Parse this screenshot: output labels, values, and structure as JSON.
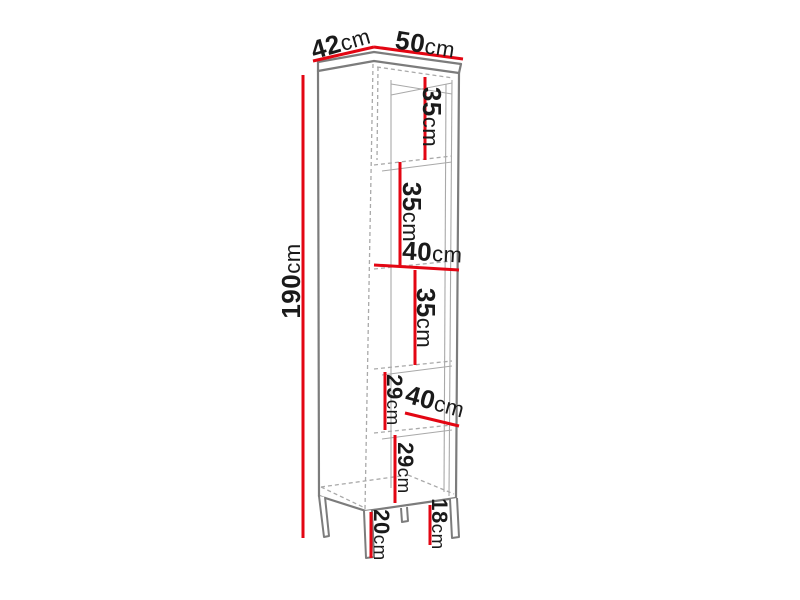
{
  "colors": {
    "red": "#e30613",
    "outline": "#7c7c7c",
    "outline_light": "#a9a9a9",
    "text": "#1a1a1a",
    "background": "#ffffff"
  },
  "diagram": {
    "type": "furniture dimension drawing (tall shelving cabinet on legs)",
    "overall": {
      "height": {
        "value": "190",
        "unit": "cm"
      },
      "depth": {
        "value": "42",
        "unit": "cm"
      },
      "width": {
        "value": "50",
        "unit": "cm"
      }
    },
    "compartments": [
      {
        "value": "35",
        "unit": "cm"
      },
      {
        "value": "35",
        "unit": "cm"
      },
      {
        "value": "40",
        "unit": "cm"
      },
      {
        "value": "35",
        "unit": "cm"
      },
      {
        "value": "29",
        "unit": "cm"
      },
      {
        "value": "40",
        "unit": "cm"
      },
      {
        "value": "29",
        "unit": "cm"
      }
    ],
    "legs": [
      {
        "value": "20",
        "unit": "cm"
      },
      {
        "value": "18",
        "unit": "cm"
      }
    ]
  }
}
